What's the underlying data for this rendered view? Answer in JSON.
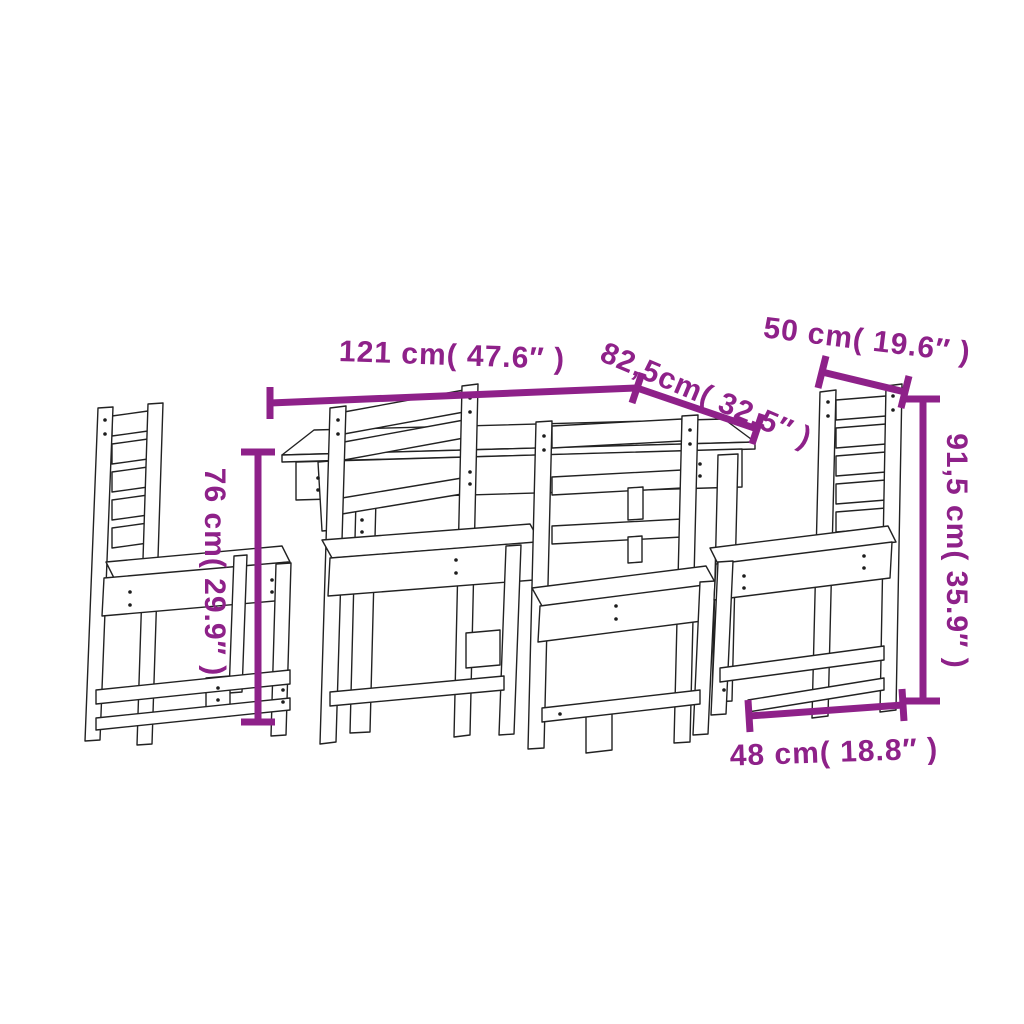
{
  "figure": {
    "subject": "5-piece wooden garden dining set",
    "style": "outline line drawing with dimension arrows"
  },
  "colors": {
    "accent": "#8E2189",
    "line": "#222222",
    "background": "#FFFFFF"
  },
  "annotations": {
    "table_width": "121 cm( 47.6″ )",
    "table_depth": "82,5cm( 32.5″ )",
    "chair_back_width": "50 cm( 19.6″ )",
    "chair_height": "91,5 cm( 35.9″ )",
    "table_height": "76 cm( 29.9″ )",
    "chair_depth": "48 cm( 18.8″ )"
  }
}
